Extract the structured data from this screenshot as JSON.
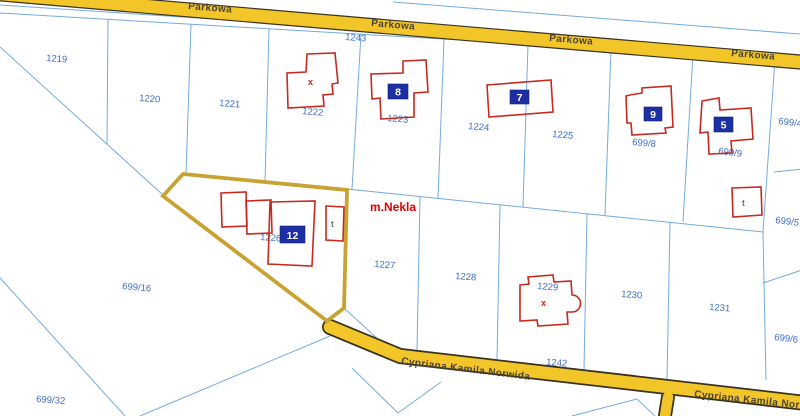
{
  "map": {
    "place_label": "m.Nekla",
    "roads": {
      "parkowa": {
        "name": "Parkowa",
        "labels": [
          "Parkowa",
          "Parkowa",
          "Parkowa",
          "Parkowa"
        ],
        "parcel_number": "1243"
      },
      "norwida": {
        "name": "Cypriana Kamila Norwida",
        "labels": [
          "Cypriana Kamila Norwida",
          "Cypriana Kamila Nor"
        ],
        "parcel_number": "1242"
      }
    },
    "parcels": [
      {
        "label": "1219"
      },
      {
        "label": "1220"
      },
      {
        "label": "1221"
      },
      {
        "label": "1222"
      },
      {
        "label": "1223"
      },
      {
        "label": "1224"
      },
      {
        "label": "1225"
      },
      {
        "label": "699/8"
      },
      {
        "label": "699/9"
      },
      {
        "label": "699/4"
      },
      {
        "label": "699/5"
      },
      {
        "label": "699/6"
      },
      {
        "label": "1226"
      },
      {
        "label": "1227"
      },
      {
        "label": "1228"
      },
      {
        "label": "1229"
      },
      {
        "label": "1230"
      },
      {
        "label": "1231"
      },
      {
        "label": "699/16"
      },
      {
        "label": "699/32"
      }
    ],
    "building_badges": [
      {
        "number": "8"
      },
      {
        "number": "7"
      },
      {
        "number": "9"
      },
      {
        "number": "5"
      },
      {
        "number": "12"
      }
    ],
    "building_marks": {
      "cross": "x",
      "outbuilding": "t"
    },
    "colors": {
      "background": "#FFFFFF",
      "road_fill": "#F2C529",
      "road_border": "#383320",
      "road_label": "#4A4335",
      "parcel_line": "#74ABDF",
      "parcel_label": "#3D6CCB",
      "building_outline": "#C8291F",
      "badge_fill": "#1D2FA3",
      "badge_text": "#FFFFFF",
      "selected_parcel_outline": "#C8A331",
      "place_label": "#E10000"
    }
  }
}
